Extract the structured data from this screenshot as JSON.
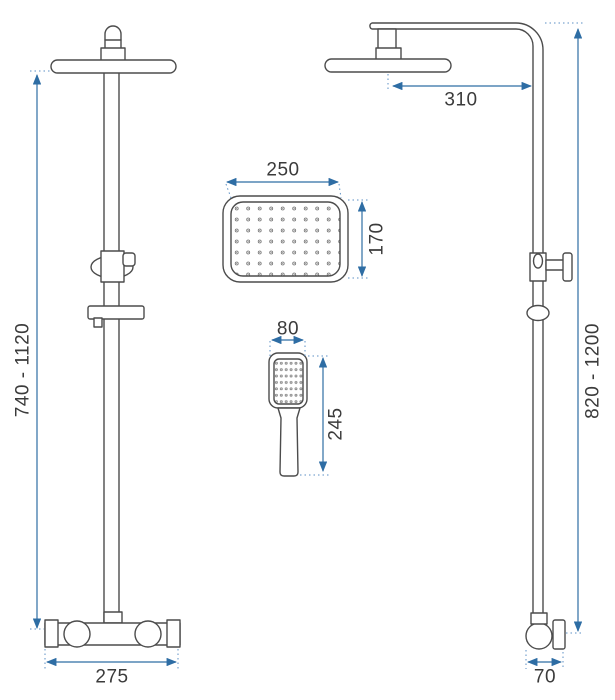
{
  "figure": {
    "kind": "technical-dimension-drawing",
    "subject": "rain shower column set: front view, side view, overhead shower face, hand shower"
  },
  "colors": {
    "background": "#ffffff",
    "drawing_line": "#4c4c4c",
    "dimension_line": "#2e6da4",
    "dimension_text": "#3b3b3b"
  },
  "views": {
    "front_view": {
      "dimensions": {
        "height_range": "740 - 1120",
        "base_width": "275"
      }
    },
    "side_view": {
      "dimensions": {
        "head_reach": "310",
        "height_range": "820 - 1200",
        "wall_bracket_depth": "70"
      }
    },
    "rain_head_face": {
      "dimensions": {
        "width": "250",
        "depth": "170"
      }
    },
    "hand_shower": {
      "dimensions": {
        "head_width": "80",
        "length": "245"
      }
    }
  }
}
